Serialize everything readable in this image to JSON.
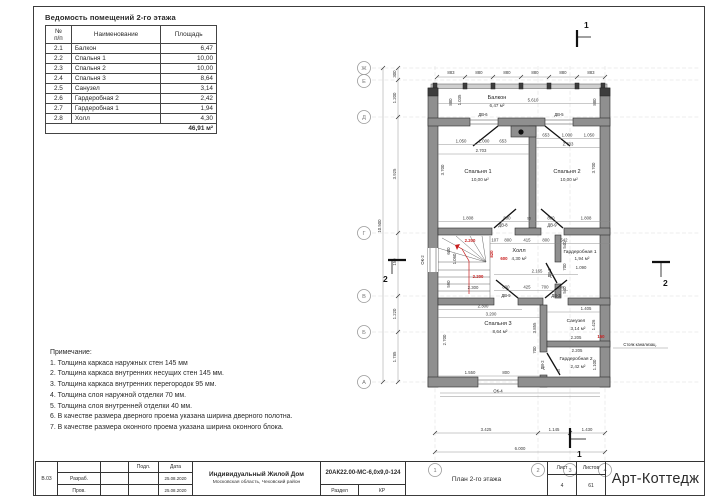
{
  "room_table": {
    "title": "Ведомость помещений 2-го этажа",
    "headers": {
      "num1": "№",
      "num2": "п/п",
      "name": "Наименование",
      "area": "Площадь"
    },
    "rows": [
      {
        "num": "2.1",
        "name": "Балкон",
        "area": "6,47"
      },
      {
        "num": "2.2",
        "name": "Спальня 1",
        "area": "10,00"
      },
      {
        "num": "2.3",
        "name": "Спальня 2",
        "area": "10,00"
      },
      {
        "num": "2.4",
        "name": "Спальня 3",
        "area": "8,64"
      },
      {
        "num": "2.5",
        "name": "Санузел",
        "area": "3,14"
      },
      {
        "num": "2.6",
        "name": "Гардеробная 2",
        "area": "2,42"
      },
      {
        "num": "2.7",
        "name": "Гардеробная 1",
        "area": "1,94"
      },
      {
        "num": "2.8",
        "name": "Холл",
        "area": "4,30"
      }
    ],
    "total": "46,91 м²"
  },
  "notes": {
    "title": "Примечание:",
    "items": [
      "1. Толщина каркаса наружных стен 145 мм",
      "2. Толщина каркаса внутренних несущих стен 145 мм.",
      "3. Толщина каркаса внутренних перегородок 95 мм.",
      "4. Толщина слоя наружной отделки 70 мм.",
      "5. Толщина слоя внутренней отделки 40 мм.",
      "6. В качестве размера дверного проема указана ширина дверного полотна.",
      "7. В качестве размера оконного проема указана ширина оконного блока."
    ]
  },
  "title_block": {
    "stamp": "В.03",
    "role1": "Разраб.",
    "role2": "Пров.",
    "sign_header": "Подл.",
    "date_header": "Дата",
    "date1": "25.08.2020",
    "date2": "25.08.2020",
    "project_title": "Индивидуальный Жилой Дом",
    "project_subtitle": "Московская область, Чеховский район",
    "doc_code": "20АК22.00-МС-6,0х9,0-124",
    "section_label": "Раздел",
    "section_value": "КР",
    "sheet_title": "План 2-го этажа",
    "sheet_label": "Лист",
    "sheet_number": "4",
    "sheets_label": "Листов",
    "sheets_total": "61",
    "company": "Арт-Коттедж"
  },
  "plan": {
    "axes": {
      "left": [
        "Ж",
        "Е",
        "Д",
        "Г",
        "В",
        "Б",
        "А"
      ],
      "bottom": [
        "1",
        "2",
        "3",
        "4"
      ]
    },
    "sections": {
      "s1": "1",
      "s2": "2"
    },
    "dims": {
      "top": [
        "883",
        "880",
        "880",
        "880",
        "880",
        "883"
      ],
      "left": [
        "300",
        "1.200",
        "3.925",
        "150",
        "1.220",
        "1.785"
      ],
      "left_total": "10.500",
      "bottom": [
        "3.425",
        "1.145",
        "1.430"
      ],
      "bottom_total": "6.000"
    },
    "rooms": {
      "balcony": {
        "name": "Балкон",
        "area": "6,47 м²"
      },
      "bedroom1": {
        "name": "Спальня 1",
        "area": "10,00 м²"
      },
      "bedroom2": {
        "name": "Спальня 2",
        "area": "10,00 м²"
      },
      "bedroom3": {
        "name": "Спальня 3",
        "area": "8,64 м²"
      },
      "hall": {
        "name": "Холл",
        "area": "4,30 м²"
      },
      "bath": {
        "name": "Санузел",
        "area": "3,14 м²"
      },
      "ward1": {
        "name": "Гардеробная 1",
        "area": "1,94 м²"
      },
      "ward2": {
        "name": "Гардеробная 2",
        "area": "2,42 м²"
      }
    },
    "labels": {
      "ok2": "ОК-2",
      "ok4": "ОК-4",
      "dv2": "ДВ-2",
      "dv3": "ДВ-3",
      "dv5": "ДВ-5",
      "dv6": "ДВ-6",
      "dv8": "ДВ-8",
      "dv9": "ДВ-9",
      "sewer": "Стояк канализац."
    },
    "inner": {
      "balcony_w": "5.610",
      "balcony_l1": "880",
      "balcony_l2": "1.035",
      "balcony_r": "880",
      "b1_row": [
        "1.050",
        "1.000",
        "653"
      ],
      "b1_w": "2.703",
      "b1_h": "3.700",
      "b2_row": [
        "653",
        "1.000",
        "1.050"
      ],
      "b2_w": "2.703",
      "b2_h": "3.700",
      "bed_bottom": [
        "1.808",
        "800",
        "95",
        "800",
        "1.808"
      ],
      "hall_top": [
        "107",
        "800",
        "415",
        "800",
        "542"
      ],
      "hall_mid": "2.165",
      "hall_bottom": [
        "800",
        "425",
        "700",
        "140"
      ],
      "ward1_w": "1.090",
      "ward1_v": [
        "540",
        "700",
        "540"
      ],
      "stair_v1": "600",
      "stair_v2": "1.060",
      "stair_v3": "590",
      "stair_w": "2.300",
      "bed3_w1": "2.300",
      "bed3_w2": "3.200",
      "bed3_h": "2.700",
      "bed3_b1": "1.550",
      "bed3_b2": "800",
      "bed3_r1": "3.855",
      "bed3_r2": "700",
      "bath_t": "1.405",
      "bath_w": "2.205",
      "bath_h": "1.426",
      "ward2_w": "2.205",
      "ward2_h": "1.100",
      "ward2_s": "45"
    },
    "red": {
      "r1": "2.200",
      "r2": "820",
      "r3": "600",
      "r4": "2.200",
      "r5": "150"
    }
  }
}
